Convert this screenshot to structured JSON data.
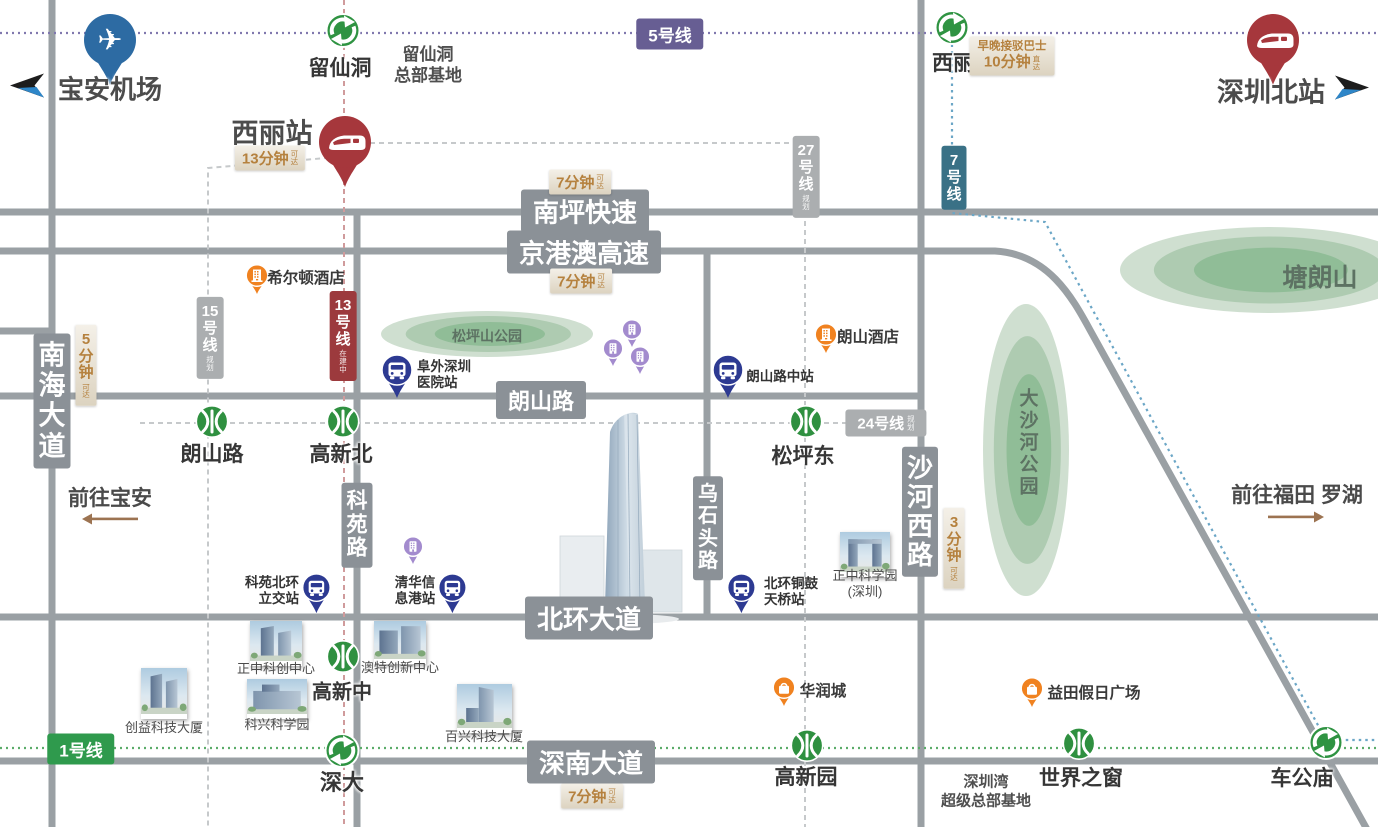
{
  "colors": {
    "road": "#9aa0a4",
    "road_badge": "#8b9197",
    "line5": "#675e93",
    "line5_dot": "#8078ae",
    "line7": "#3a7186",
    "line7_dot": "#6ba6c6",
    "line1": "#2f9a4d",
    "line1_dot": "#5bac69",
    "line13": "#9c3a3d",
    "line13_dash": "#d09b9c",
    "line_gray": "#abaeb0",
    "line_gray_dash": "#c6c9cb",
    "metro_green": "#2f9040",
    "bus_navy": "#2d3a92",
    "hsr_red": "#a6373c",
    "airport_blue": "#2d6ba3",
    "poi_orange": "#f08220",
    "pin_purple": "#a38bce",
    "time_gold": "#b5813e",
    "park_outer": "#cfdfd0",
    "park_mid": "#aecbb1",
    "park_inner": "#90bd97",
    "arrow_brown": "#9c7351",
    "arrow_black": "#1d1d1d",
    "arrow_blue": "#2e86c8"
  },
  "roads": {
    "segments": [
      {
        "name": "nanping-expressway",
        "d": "M0,212 H1378"
      },
      {
        "name": "jinggangao-expressway",
        "d": "M0,251 H995 C1048,254 1072,297 1090,330 L1369,833"
      },
      {
        "name": "langshan-road",
        "d": "M0,396 H921"
      },
      {
        "name": "beihuan-avenue",
        "d": "M0,617 H1378"
      },
      {
        "name": "shennan-avenue",
        "d": "M0,761 H1378"
      },
      {
        "name": "nanhai-avenue",
        "d": "M52,0 V827"
      },
      {
        "name": "east-road",
        "d": "M921,0 V827"
      },
      {
        "name": "wushitou-road",
        "d": "M707,251 V617"
      },
      {
        "name": "keyuan-road",
        "d": "M357,212 V827"
      },
      {
        "name": "west-stub",
        "d": "M0,331 H52"
      }
    ],
    "badges": [
      {
        "label": "南坪快速",
        "orient": "h",
        "x": 585,
        "y": 211,
        "fs": 26
      },
      {
        "label": "京港澳高速",
        "orient": "h",
        "x": 584,
        "y": 252,
        "fs": 26
      },
      {
        "label": "朗山路",
        "orient": "h",
        "x": 541,
        "y": 400,
        "fs": 22
      },
      {
        "label": "北环大道",
        "orient": "h",
        "x": 589,
        "y": 618,
        "fs": 26
      },
      {
        "label": "深南大道",
        "orient": "h",
        "x": 591,
        "y": 762,
        "fs": 26
      },
      {
        "label": "南海大道",
        "orient": "v",
        "x": 52,
        "y": 401,
        "fs": 27
      },
      {
        "label": "科苑路",
        "orient": "v",
        "x": 357,
        "y": 525,
        "fs": 21
      },
      {
        "label": "乌石头路",
        "orient": "v",
        "x": 708,
        "y": 528,
        "fs": 20
      },
      {
        "label": "沙河西路",
        "orient": "v",
        "x": 920,
        "y": 512,
        "fs": 26
      }
    ]
  },
  "rail": {
    "lines": [
      {
        "name": "line-5",
        "color": "line5_dot",
        "dash": "2 4",
        "w": 2.2,
        "d": "M0,33 H1378"
      },
      {
        "name": "line-1",
        "color": "line1_dot",
        "dash": "2 4",
        "w": 2.2,
        "d": "M0,748 H1378"
      },
      {
        "name": "line-7",
        "color": "line7_dot",
        "dash": "2.5 4",
        "w": 2.2,
        "d": "M952,12 V213 L1045,222 L1326,740 H1378"
      },
      {
        "name": "line-13",
        "color": "line13_dash",
        "dash": "5 4",
        "w": 2,
        "d": "M344,0 V827"
      },
      {
        "name": "line-15",
        "color": "line_gray_dash",
        "dash": "5 4",
        "w": 2,
        "d": "M338,157 L208,168 V827"
      },
      {
        "name": "line-27",
        "color": "line_gray_dash",
        "dash": "5 4",
        "w": 2,
        "d": "M352,143 H805 V827"
      },
      {
        "name": "line-24",
        "color": "line_gray_dash",
        "dash": "5 4",
        "w": 2,
        "d": "M140,423 H921"
      }
    ],
    "badges": [
      {
        "label": "5号线",
        "sub": "",
        "orient": "h",
        "x": 670,
        "y": 34,
        "bg": "line5",
        "fs": 17
      },
      {
        "label": "1号线",
        "sub": "",
        "orient": "h",
        "x": 81,
        "y": 749,
        "bg": "line1",
        "fs": 17
      },
      {
        "label": "7号线",
        "sub": "",
        "orient": "v",
        "x": 954,
        "y": 178,
        "bg": "line7",
        "fs": 15
      },
      {
        "label": "13号线",
        "sub": "在建中",
        "orient": "v",
        "x": 343,
        "y": 336,
        "bg": "line13",
        "fs": 15
      },
      {
        "label": "15号线",
        "sub": "规划",
        "orient": "v",
        "x": 210,
        "y": 338,
        "bg": "line_gray",
        "fs": 15
      },
      {
        "label": "27号线",
        "sub": "规划",
        "orient": "v",
        "x": 806,
        "y": 177,
        "bg": "line_gray",
        "fs": 15
      },
      {
        "label": "24号线",
        "sub": "规划",
        "orient": "h",
        "x": 886,
        "y": 423,
        "bg": "line_gray",
        "fs": 15
      }
    ]
  },
  "stations": [
    {
      "name": "留仙洞",
      "type": "interchange",
      "x": 343,
      "y": 33,
      "lx": 340,
      "ly": 67,
      "fs": 21
    },
    {
      "name": "西丽",
      "type": "interchange",
      "x": 952,
      "y": 30,
      "lx": 953,
      "ly": 62,
      "fs": 21
    },
    {
      "name": "深大",
      "type": "interchange",
      "x": 342,
      "y": 753,
      "lx": 342,
      "ly": 781,
      "fs": 22
    },
    {
      "name": "车公庙",
      "type": "interchange",
      "x": 1326,
      "y": 745,
      "lx": 1302,
      "ly": 777,
      "fs": 21
    },
    {
      "name": "朗山路",
      "type": "metro",
      "x": 212,
      "y": 424,
      "lx": 212,
      "ly": 453,
      "fs": 21
    },
    {
      "name": "高新北",
      "type": "metro",
      "x": 343,
      "y": 424,
      "lx": 341,
      "ly": 453,
      "fs": 21
    },
    {
      "name": "松坪东",
      "type": "metro",
      "x": 806,
      "y": 424,
      "lx": 803,
      "ly": 455,
      "fs": 21
    },
    {
      "name": "高新中",
      "type": "metro",
      "x": 343,
      "y": 659,
      "lx": 342,
      "ly": 690,
      "fs": 20
    },
    {
      "name": "高新园",
      "type": "metro",
      "x": 807,
      "y": 748,
      "lx": 806,
      "ly": 776,
      "fs": 21
    },
    {
      "name": "世界之窗",
      "type": "metro",
      "x": 1079,
      "y": 746,
      "lx": 1081,
      "ly": 777,
      "fs": 21
    }
  ],
  "terminals": [
    {
      "name": "宝安机场",
      "type": "airport",
      "px": 110,
      "py": 40,
      "lx": 110,
      "ly": 88,
      "fs": 26,
      "arrow": "left",
      "ax": 30,
      "ay": 88
    },
    {
      "name": "西丽站",
      "type": "hsr",
      "px": 345,
      "py": 142,
      "lx": 272,
      "ly": 131,
      "fs": 27,
      "arrow": ""
    },
    {
      "name": "深圳北站",
      "type": "hsr",
      "px": 1273,
      "py": 40,
      "lx": 1271,
      "ly": 90,
      "fs": 27,
      "arrow": "right",
      "ax": 1349,
      "ay": 90
    }
  ],
  "bus_stops": [
    {
      "lines": [
        "阜外深圳",
        "医院站"
      ],
      "x": 397,
      "y": 370,
      "size": 46,
      "side": "right",
      "lx": 444,
      "ly": 375
    },
    {
      "lines": [
        "朗山路中站"
      ],
      "x": 728,
      "y": 370,
      "size": 46,
      "side": "right",
      "lx": 780,
      "ly": 377
    },
    {
      "lines": [
        "科苑北环",
        "立交站"
      ],
      "x": 316,
      "y": 588,
      "size": 42,
      "side": "left",
      "lx": 272,
      "ly": 591
    },
    {
      "lines": [
        "清华信",
        "息港站"
      ],
      "x": 452,
      "y": 588,
      "size": 42,
      "side": "left",
      "lx": 415,
      "ly": 591
    },
    {
      "lines": [
        "北环铜鼓",
        "天桥站"
      ],
      "x": 741,
      "y": 588,
      "size": 42,
      "side": "right",
      "lx": 791,
      "ly": 592
    }
  ],
  "pois": [
    {
      "name": "希尔顿酒店",
      "glyph": "hotel",
      "x": 257,
      "y": 276,
      "lx": 306,
      "ly": 277
    },
    {
      "name": "朗山酒店",
      "glyph": "hotel",
      "x": 826,
      "y": 335,
      "lx": 868,
      "ly": 336
    },
    {
      "name": "华润城",
      "glyph": "mall",
      "x": 784,
      "y": 688,
      "lx": 823,
      "ly": 690
    },
    {
      "name": "益田假日广场",
      "glyph": "mall",
      "x": 1032,
      "y": 689,
      "lx": 1094,
      "ly": 692
    }
  ],
  "project_pins": [
    {
      "x": 632,
      "y": 330
    },
    {
      "x": 613,
      "y": 349
    },
    {
      "x": 640,
      "y": 357
    },
    {
      "x": 413,
      "y": 547
    }
  ],
  "buildings": [
    {
      "name": "创益科技大厦",
      "cx": 164,
      "top": 668,
      "w": 46,
      "h": 46,
      "ly": 728,
      "variant": "twin"
    },
    {
      "name": "正中科创中心",
      "cx": 276,
      "top": 621,
      "w": 52,
      "h": 40,
      "ly": 669,
      "variant": "twin"
    },
    {
      "name": "科兴科学园",
      "cx": 277,
      "top": 679,
      "w": 60,
      "h": 35,
      "ly": 725,
      "variant": "wide"
    },
    {
      "name": "澳特创新中心",
      "cx": 400,
      "top": 621,
      "w": 52,
      "h": 38,
      "ly": 668,
      "variant": "blocks"
    },
    {
      "name": "百兴科技大厦",
      "cx": 484,
      "top": 684,
      "w": 55,
      "h": 44,
      "ly": 737,
      "variant": "tall"
    },
    {
      "name": "正中科学园",
      "name2": "(深圳)",
      "cx": 865,
      "top": 532,
      "w": 50,
      "h": 40,
      "ly": 584,
      "variant": "gate"
    }
  ],
  "landmark_tower": {
    "left": 558,
    "top": 408,
    "w": 126,
    "h": 218
  },
  "parks": [
    {
      "name": "松坪山公园",
      "cx": 487,
      "cy": 334,
      "rx": 106,
      "ry": 23,
      "tx": 487,
      "ty": 336,
      "orient": "h",
      "fs": 14
    },
    {
      "name": "大沙河公园",
      "cx": 1026,
      "cy": 450,
      "rx": 43,
      "ry": 146,
      "tx": 1027,
      "ty": 443,
      "orient": "v",
      "fs": 19
    },
    {
      "name": "塘朗山",
      "cx": 1268,
      "cy": 270,
      "rx": 148,
      "ry": 43,
      "tx": 1320,
      "ty": 276,
      "orient": "h",
      "fs": 25
    }
  ],
  "time_labels": [
    {
      "text": "13分钟",
      "suffix": "可达",
      "orient": "h",
      "x": 270,
      "y": 158
    },
    {
      "text": "7分钟",
      "suffix": "可达",
      "orient": "h",
      "x": 580,
      "y": 182
    },
    {
      "text": "7分钟",
      "suffix": "可达",
      "orient": "h",
      "x": 581,
      "y": 281
    },
    {
      "text": "7分钟",
      "suffix": "可达",
      "orient": "h",
      "x": 592,
      "y": 796
    },
    {
      "text": "5分钟",
      "suffix": "可达",
      "orient": "v",
      "x": 86,
      "y": 365
    },
    {
      "text": "3分钟",
      "suffix": "可达",
      "orient": "v",
      "x": 954,
      "y": 548
    },
    {
      "line1": "早晚接驳巴士",
      "text": "10分钟",
      "suffix": "直达",
      "orient": "h2",
      "x": 1012,
      "y": 56
    }
  ],
  "directions": [
    {
      "text": "前往宝安",
      "arrow": "left",
      "x": 110,
      "y": 497,
      "ax": 110,
      "ay": 521
    },
    {
      "text": "前往福田 罗湖",
      "arrow": "right",
      "x": 1297,
      "y": 494,
      "ax": 1296,
      "ay": 519
    }
  ],
  "notes": [
    {
      "lines": [
        "留仙洞",
        "总部基地"
      ],
      "x": 428,
      "y": 65,
      "fs": 17
    },
    {
      "lines": [
        "深圳湾",
        "超级总部基地"
      ],
      "x": 986,
      "y": 792,
      "fs": 15
    }
  ]
}
